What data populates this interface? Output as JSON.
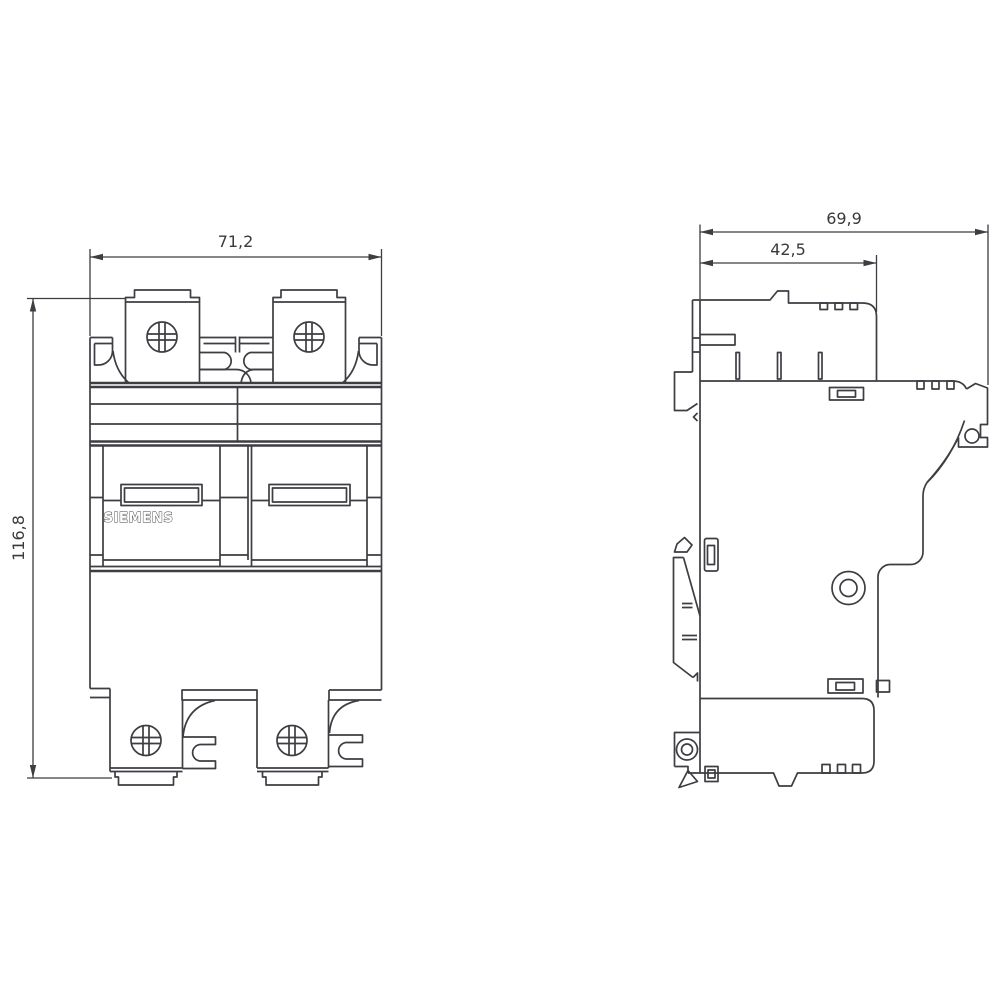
{
  "page": {
    "background": "#ffffff"
  },
  "drawing": {
    "brand_label": "SIEMENS",
    "dimensions": {
      "front_width_mm": "71,2",
      "front_height_mm": "116,8",
      "side_depth_total_mm": "69,9",
      "side_depth_body_mm": "42,5"
    },
    "colors": {
      "line": "#3d3d42",
      "dimension_text": "#3a3a3a",
      "background": "#ffffff"
    }
  }
}
